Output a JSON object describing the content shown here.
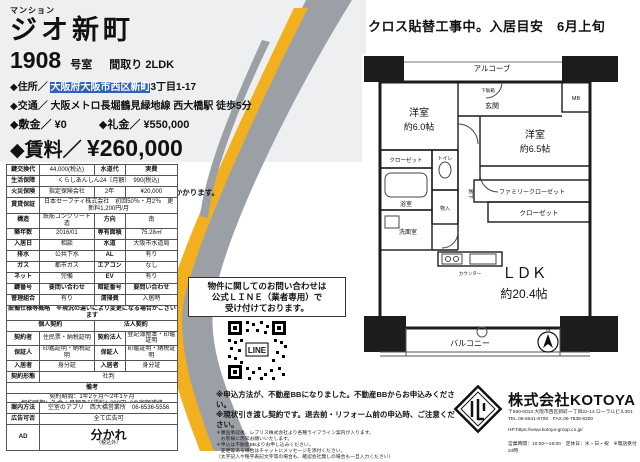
{
  "colors": {
    "accent_yellow": "#f2b01e",
    "swoosh_gray": "#9aa0a6",
    "panel_gray": "#edeff1"
  },
  "header": {
    "category": "マンション",
    "name": "ジオ新町",
    "room_no": "1908",
    "room_suffix": "号室",
    "madori_label": "間取り",
    "madori": "2LDK",
    "addr_label": "◆住所／",
    "addr_hl": "大阪府大阪市西区新町",
    "addr_rest": "3丁目1-17",
    "access_label": "◆交通／",
    "access": "大阪メトロ長堀鶴見緑地線 西大橋駅 徒歩5分",
    "shikikin_label": "◆敷金／",
    "shikikin": "¥0",
    "reikin_label": "◆礼金／",
    "reikin": "¥550,000",
    "rent_label": "◆賃料／",
    "rent": "¥260,000",
    "kyoueki_label": "◆共益費／",
    "kyoueki": "¥20,000",
    "tax_note": "※賃料・共益費は、事務用の場合、別途消費税がかかります。"
  },
  "banner": "クロス貼替工事中。入居目安　6月上旬",
  "spec": {
    "r1": {
      "l1": "鍵交換代",
      "v1": "44,000(税込)",
      "l2": "水道代",
      "v2": "実費"
    },
    "r2": {
      "l1": "生活保障",
      "v1": "くらしあんしん24〔月額〕　990(税込)"
    },
    "r3": {
      "l1": "火災保険",
      "v1": "指定保険会社",
      "l2": "2年",
      "v2": "¥20,000"
    },
    "r4": {
      "l1": "賃貸保証",
      "v1": "日本セーフティ株式会社　初回50％・月2％　更新料1,200円/月"
    },
    "r5": {
      "l1": "構造",
      "v1": "鉄筋コンクリート造",
      "l2": "方向",
      "v2": "南"
    },
    "r6": {
      "l1": "築年数",
      "v1": "2016/01",
      "l2": "専有面積",
      "v2": "75.28㎡"
    },
    "r7": {
      "l1": "入居日",
      "v1": "相談",
      "l2": "水道",
      "v2": "大阪市水道局"
    },
    "r8": {
      "l1": "排水",
      "v1": "公共下水",
      "l2": "AL",
      "v2": "有り"
    },
    "r9": {
      "l1": "ガス",
      "v1": "都市ガス",
      "l2": "エアコン",
      "v2": "なし"
    },
    "r10": {
      "l1": "ネット",
      "v1": "完備",
      "l2": "EV",
      "v2": "有り"
    },
    "r11": {
      "l1": "鍵番号",
      "v1": "要問い合わせ",
      "l2": "暗証番号",
      "v2": "要問い合わせ"
    },
    "r12": {
      "l1": "管理組合",
      "v1": "有り",
      "l2": "清掃費",
      "v2": "入居時"
    },
    "wide_note": "設備仕様等概略　※現況の違いにより変更になる場合がございます",
    "hdr_personal": "個人契約",
    "hdr_corporate": "法人契約",
    "c1": {
      "l1": "契約者",
      "v1": "住民票・納税証明",
      "l2": "契約法人",
      "v2": "登記簿謄本・印鑑証明"
    },
    "c2": {
      "l1": "保証人",
      "v1": "印鑑証明・納税証明",
      "l2": "保証人",
      "v2": "印鑑証明・納税証明"
    },
    "c3": {
      "l1": "入居者",
      "v1": "身分証",
      "l2": "入居者",
      "v2": "身分証"
    },
    "c4": {
      "l1": "契約形態",
      "v1": "社判"
    },
    "biko_title": "備考",
    "biko1": "契約期間：1年2ヶ月〜2年1ヶ月",
    "biko2": "解約時期：礼金＋月額及び賃料1,000円×2の定額補修",
    "biko3": "入居時：ハウスクリーニング代55,000円（専門業者）"
  },
  "bottom": {
    "guide_label": "案内方法",
    "guide_value": "空室のアプリ　西大橋営業所　06-6536-5556",
    "ad_ok_label": "広告可否",
    "ad_ok_value": "全て広告可",
    "ad_label": "AD",
    "ad_value": "分かれ",
    "ad_note": "〈税込外〉"
  },
  "notice": {
    "line1": "物件に関してのお問い合わせは",
    "line2": "公式ＬＩＮＥ（業者専用）で",
    "line3": "受け付けております。",
    "qr_label": "LINE"
  },
  "floorplan": {
    "alcove": "アルコーブ",
    "entrance": "玄関",
    "shoebox": "下駄箱",
    "mb": "MB",
    "room1": "洋室",
    "room1_size": "約6.0帖",
    "room2": "洋室",
    "room2_size": "約6.5帖",
    "closet1": "クローゼット",
    "toilet": "トイレ",
    "hallway": "廊下",
    "bath": "浴室",
    "wash": "洗面室",
    "storage": "物入",
    "counter": "カウンター",
    "family_closet": "ファミリークローゼット",
    "closet2": "クローゼット",
    "ldk": "ＬＤＫ",
    "ldk_size": "約20.4帖",
    "balcony": "バルコニー",
    "north": "N"
  },
  "notes": {
    "bold1": "※申込方法が、不動産BBになりました。不動産BBからお申込みください。",
    "bold2": "※現状引き渡し契約です。退去前・リフォーム前の申込時、ご注意ください。",
    "s1": "＊審査承認後、レブリス株式会社より各種ライフライン案内が入ります。",
    "s2": "　お客様に周知お願いいたします。",
    "s3": "＊申込は不動産BBよりお申し込みください。",
    "s4": "　変更等ある場合はチャットにメッセージを添付ください。",
    "s5": "（太字記入や略字表記文字等の場合も、確認会社無しの場合も一旦入力ください）"
  },
  "company": {
    "name": "株式会社KOTOYA",
    "addr": "〒550-0013 大阪市西区新町一丁目22-14 ローラルビル301",
    "telfax": "TEL.06-6541-8708　FAX.06-7636-8200",
    "url": "HP:https://www.kotoya-group.co.jp/",
    "hours": "営業時間：10:00〜19:00　定休日：水・日・祝　※電話受付24時"
  }
}
